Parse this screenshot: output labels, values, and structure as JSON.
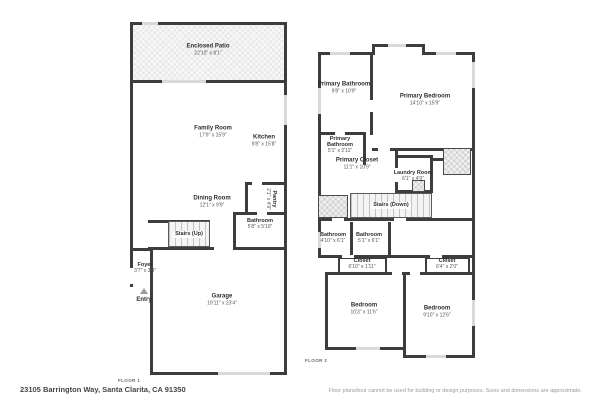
{
  "address": "23105 Barrington Way, Santa Clarita, CA 91350",
  "disclaimer": "Floor plans/tour cannot be used for building or design purposes. Sizes and dimensions are approximate.",
  "colors": {
    "wall": "#3d3d3d",
    "window_marker": "#d9d9d9",
    "text": "#2f2f2f",
    "background": "#ffffff"
  },
  "floor1": {
    "label": "FLOOR 1",
    "rooms": {
      "enclosed_patio": {
        "name": "Enclosed Patio",
        "dims": "22'10\" x 8'1\""
      },
      "family_room": {
        "name": "Family Room",
        "dims": "17'9\" x 15'9\""
      },
      "kitchen": {
        "name": "Kitchen",
        "dims": "9'8\" x 15'8\""
      },
      "dining_room": {
        "name": "Dining Room",
        "dims": "12'1\" x 9'9\""
      },
      "pantry": {
        "name": "Pantry",
        "dims": "2'1\" x 4'9\""
      },
      "bathroom": {
        "name": "Bathroom",
        "dims": "5'8\" x 5'10\""
      },
      "stairs": {
        "name": "Stairs (Up)"
      },
      "foyer": {
        "name": "Foyer",
        "dims": "3'7\" x 3'4\""
      },
      "entry": {
        "name": "Entry"
      },
      "garage": {
        "name": "Garage",
        "dims": "19'11\" x 23'4\""
      }
    }
  },
  "floor2": {
    "label": "FLOOR 2",
    "rooms": {
      "primary_bathroom_1": {
        "name": "Primary Bathroom",
        "dims": "9'8\" x 10'9\""
      },
      "primary_bedroom": {
        "name": "Primary Bedroom",
        "dims": "14'10\" x 15'9\""
      },
      "primary_bathroom_2": {
        "name": "Primary Bathroom",
        "dims": "5'1\" x 2'11\""
      },
      "primary_closet": {
        "name": "Primary Closet",
        "dims": "11'1\" x 10'9\""
      },
      "laundry_room": {
        "name": "Laundry Room",
        "dims": "6'1\" x 4'9\""
      },
      "stairs": {
        "name": "Stairs (Down)"
      },
      "bathroom_1": {
        "name": "Bathroom",
        "dims": "4'10\" x 6'1\""
      },
      "bathroom_2": {
        "name": "Bathroom",
        "dims": "5'1\" x 6'1\""
      },
      "closet_1": {
        "name": "Closet",
        "dims": "6'10\" x 1'11\""
      },
      "closet_2": {
        "name": "Closet",
        "dims": "6'4\" x 2'0\""
      },
      "bedroom_1": {
        "name": "Bedroom",
        "dims": "10'3\" x 11'6\""
      },
      "bedroom_2": {
        "name": "Bedroom",
        "dims": "9'10\" x 12'6\""
      }
    }
  }
}
